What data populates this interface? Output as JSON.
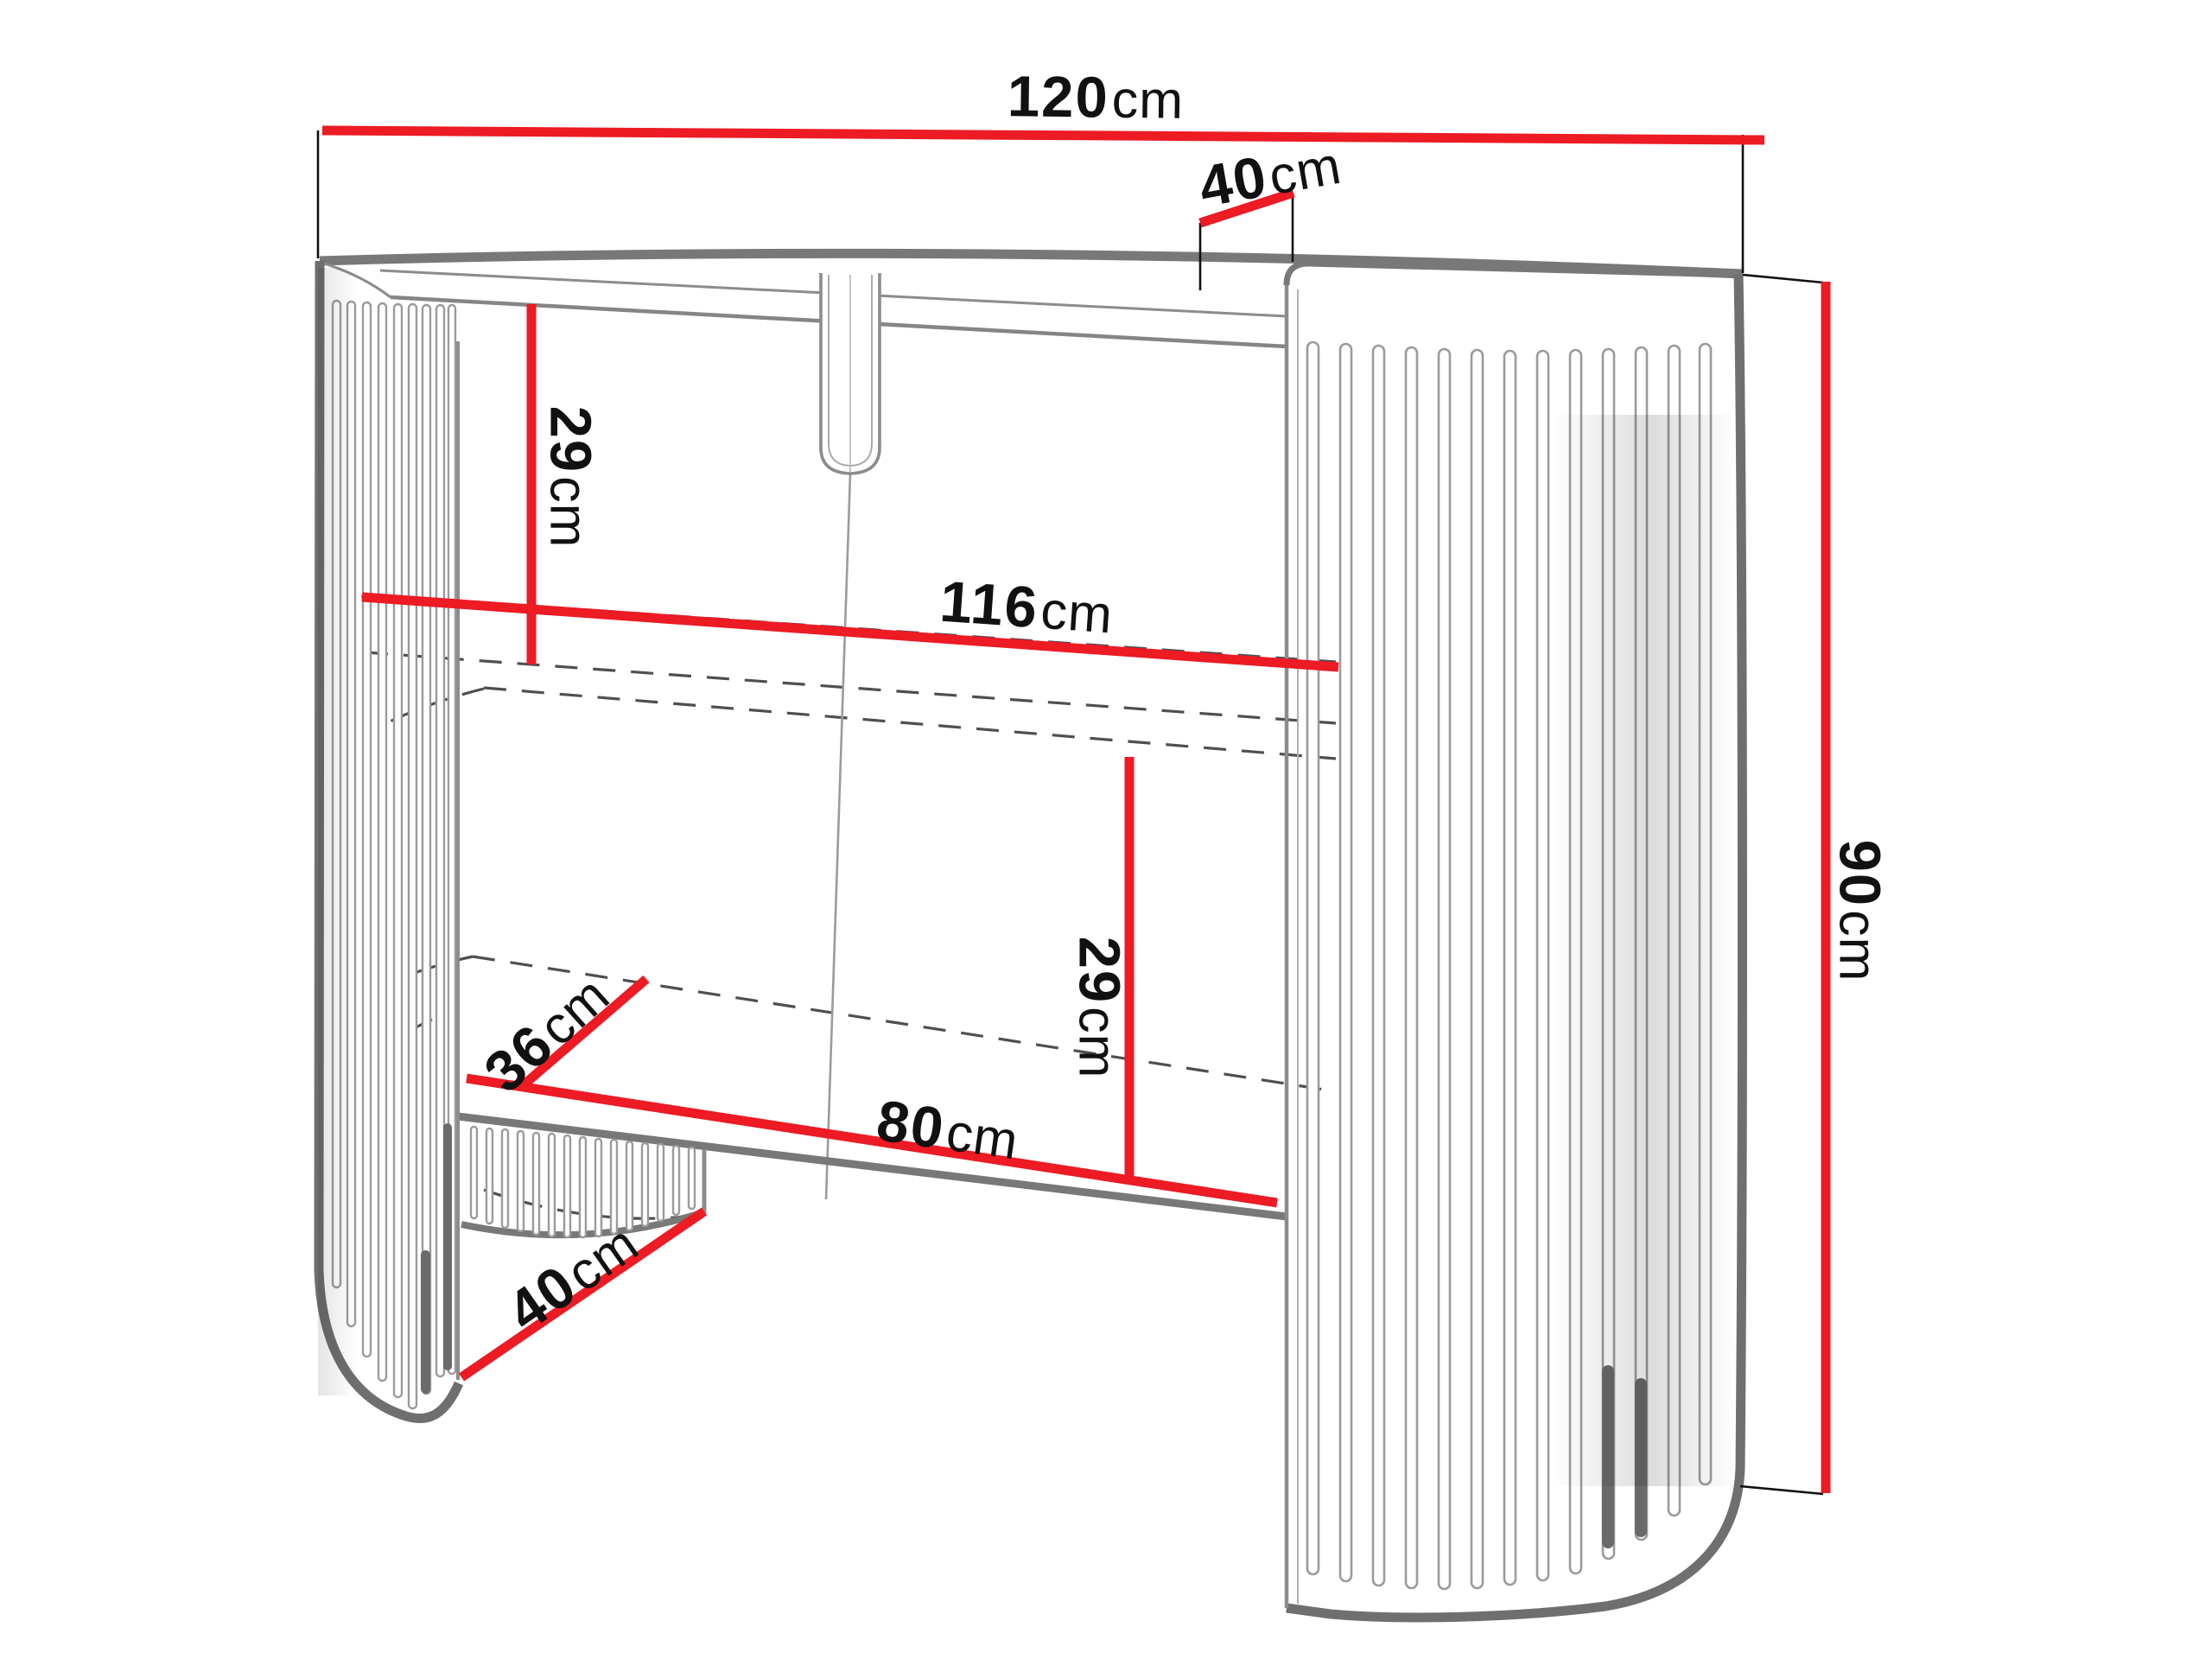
{
  "diagram": {
    "type": "furniture-dimension-drawing",
    "subject": "curved slatted dressing console with two shelf levels and arched base cutout",
    "background_color": "#ffffff",
    "colors": {
      "dimension_line": "#ec1b24",
      "outline": "#8a8a8a",
      "outline_dark": "#6f6f6f",
      "hidden_line": "#4f4f4f",
      "extension_line": "#111111",
      "label_text": "#111111"
    },
    "dimensions": {
      "overall_width": {
        "value": "120",
        "unit": "cm"
      },
      "top_depth": {
        "value": "40",
        "unit": "cm"
      },
      "top_to_shelf_gap": {
        "value": "29",
        "unit": "cm"
      },
      "inner_width": {
        "value": "116",
        "unit": "cm"
      },
      "shelf_to_base_gap": {
        "value": "29",
        "unit": "cm"
      },
      "shelf_depth": {
        "value": "36",
        "unit": "cm"
      },
      "opening_width": {
        "value": "80",
        "unit": "cm"
      },
      "base_cutout_depth": {
        "value": "40",
        "unit": "cm"
      },
      "overall_height": {
        "value": "90",
        "unit": "cm"
      }
    }
  }
}
